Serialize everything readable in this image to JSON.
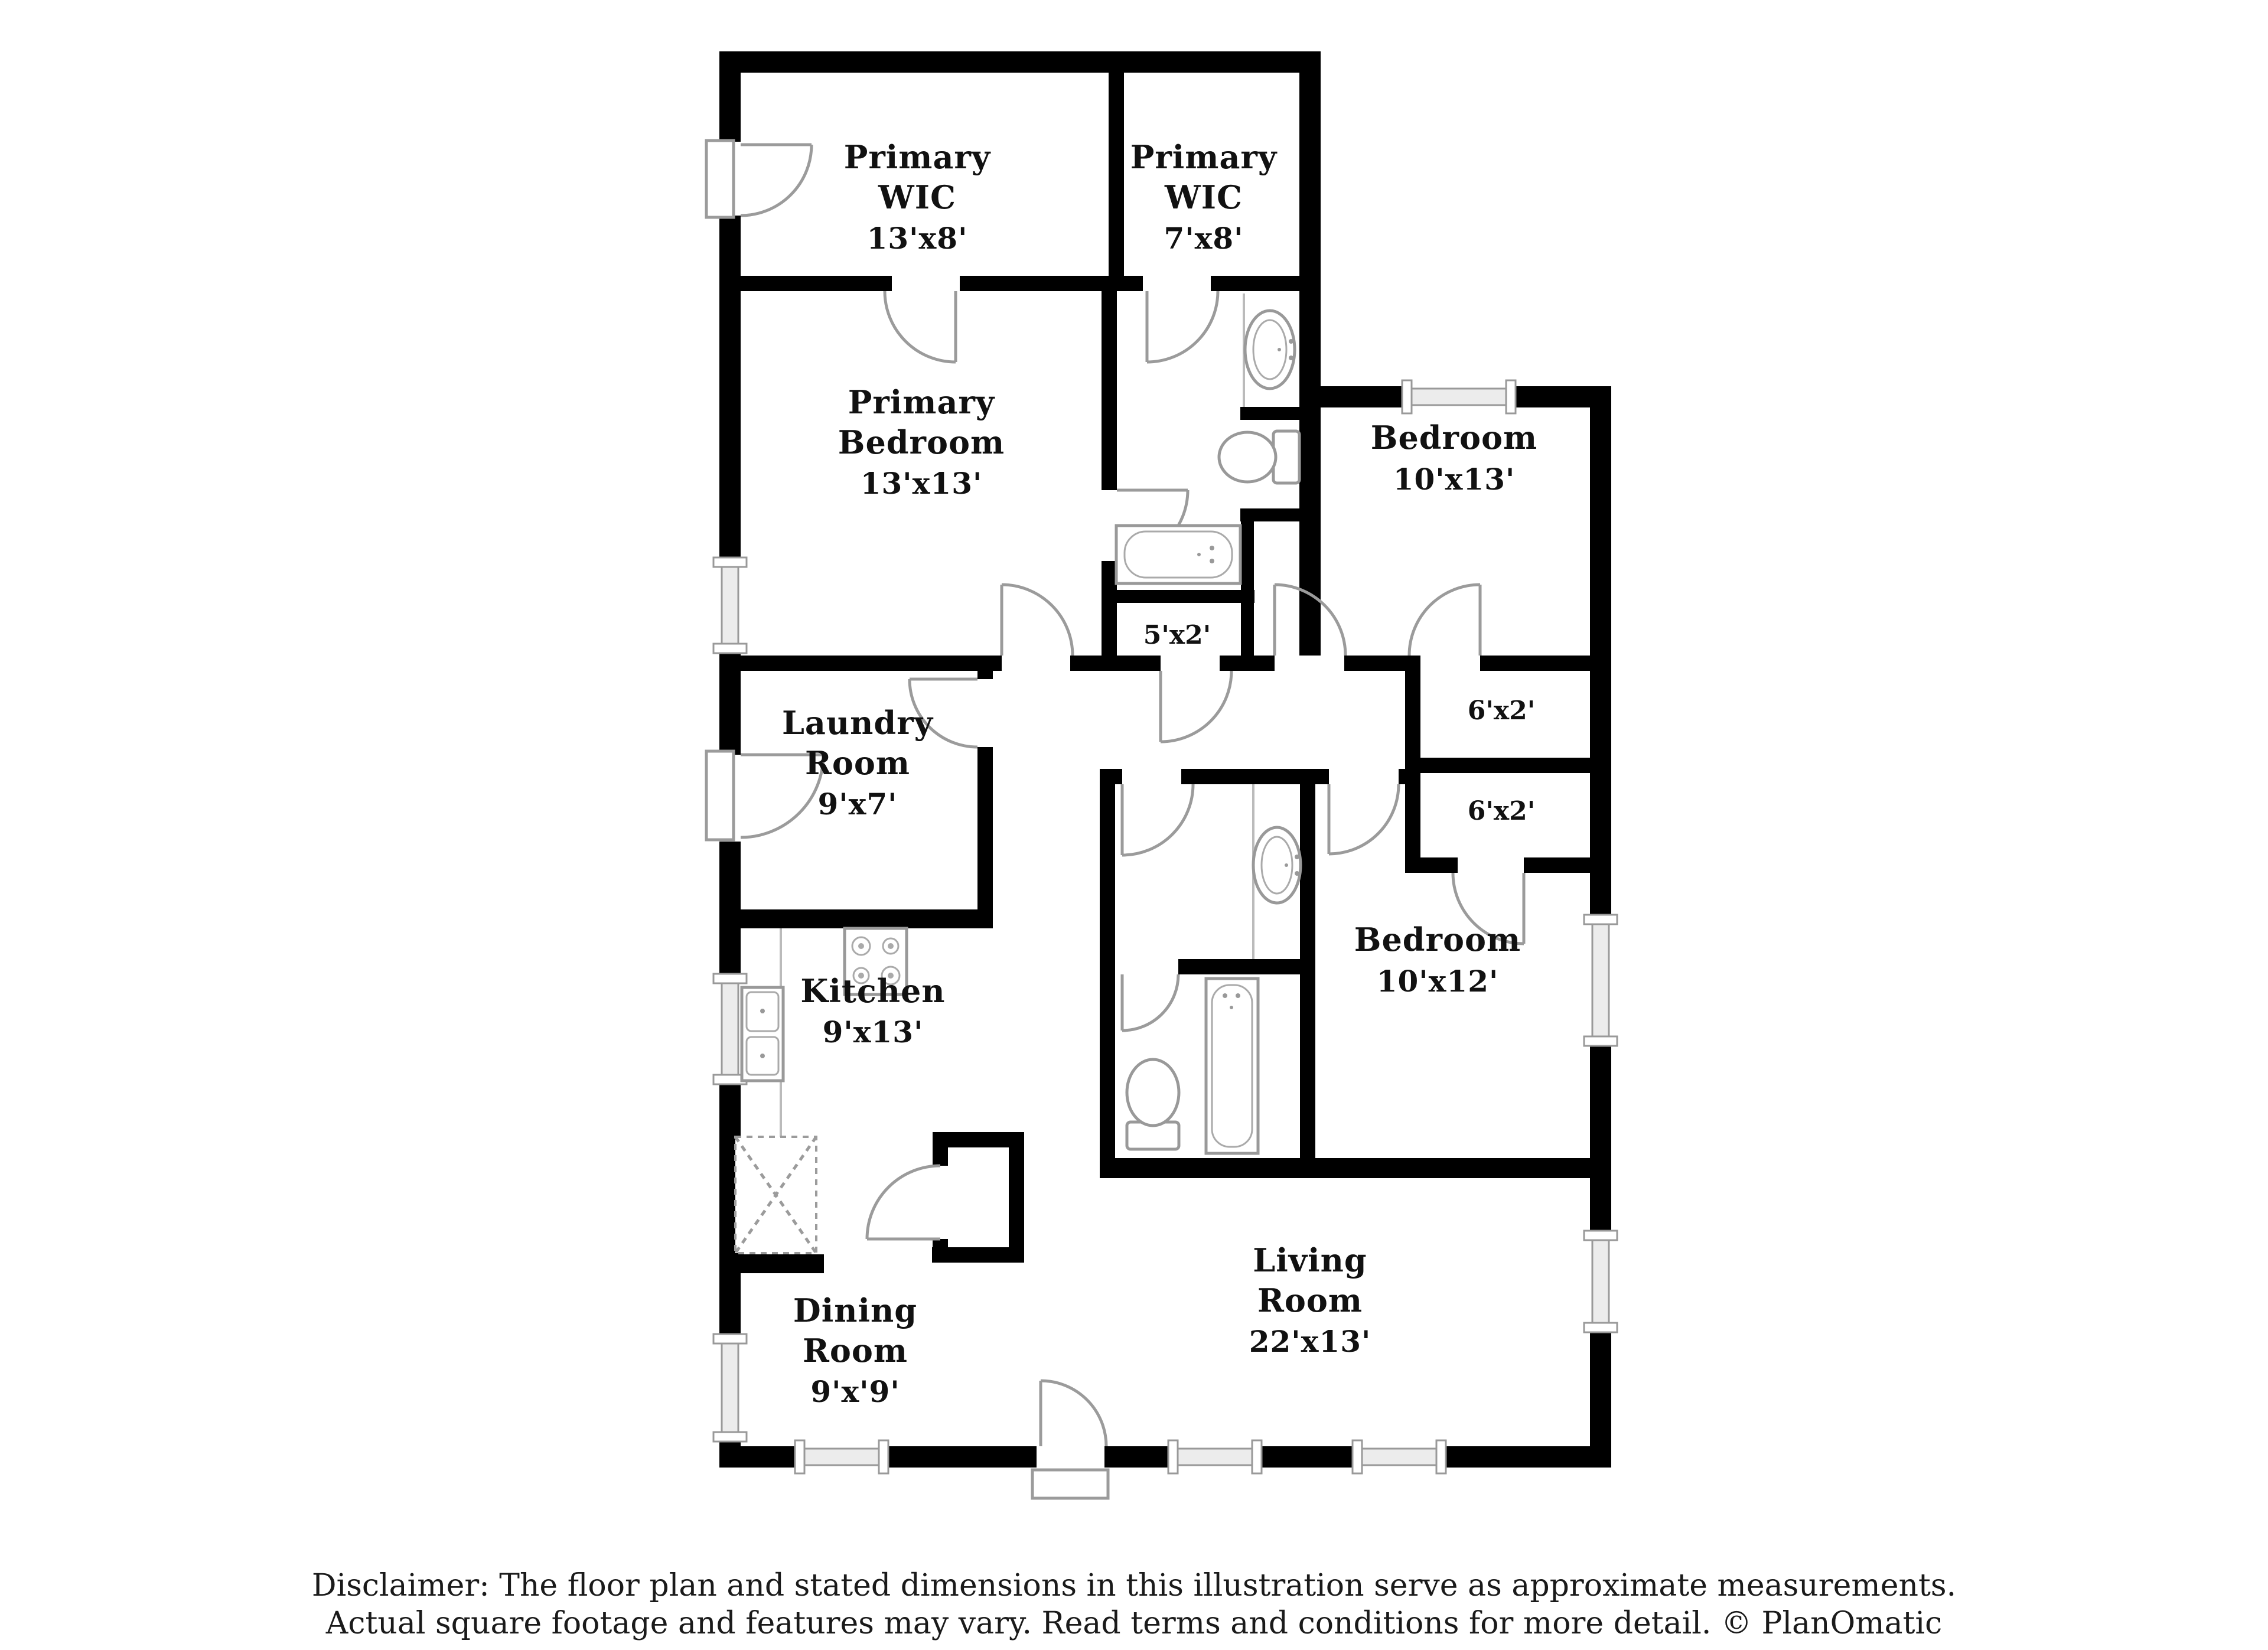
{
  "meta": {
    "document_type": "floor-plan",
    "background_color": "#ffffff",
    "wall_color": "#000000",
    "fixture_line_color": "#9b9b9b",
    "credit": "PlanOmatic"
  },
  "rooms": [
    {
      "id": "primary-wic-large",
      "lines": [
        "Primary",
        "WIC",
        "13'x8'"
      ]
    },
    {
      "id": "primary-wic-small",
      "lines": [
        "Primary",
        "WIC",
        "7'x8'"
      ]
    },
    {
      "id": "primary-bedroom",
      "lines": [
        "Primary",
        "Bedroom",
        "13'x13'"
      ]
    },
    {
      "id": "bedroom-upper",
      "lines": [
        "Bedroom",
        "10'x13'"
      ]
    },
    {
      "id": "laundry-room",
      "lines": [
        "Laundry",
        "Room",
        "9'x7'"
      ]
    },
    {
      "id": "kitchen",
      "lines": [
        "Kitchen",
        "9'x13'"
      ]
    },
    {
      "id": "bedroom-lower",
      "lines": [
        "Bedroom",
        "10'x12'"
      ]
    },
    {
      "id": "living-room",
      "lines": [
        "Living",
        "Room",
        "22'x13'"
      ]
    },
    {
      "id": "dining-room",
      "lines": [
        "Dining",
        "Room",
        "9'x'9'"
      ]
    },
    {
      "id": "closet-5x2",
      "lines": [
        "5'x2'"
      ]
    },
    {
      "id": "closet-6x2-upper",
      "lines": [
        "6'x2'"
      ]
    },
    {
      "id": "closet-6x2-lower",
      "lines": [
        "6'x2'"
      ]
    }
  ],
  "disclaimer": {
    "lines": [
      "Disclaimer: The floor plan and stated dimensions in this illustration serve as approximate measurements.",
      "Actual square footage and features may vary. Read terms and conditions for more detail. © PlanOmatic"
    ]
  }
}
